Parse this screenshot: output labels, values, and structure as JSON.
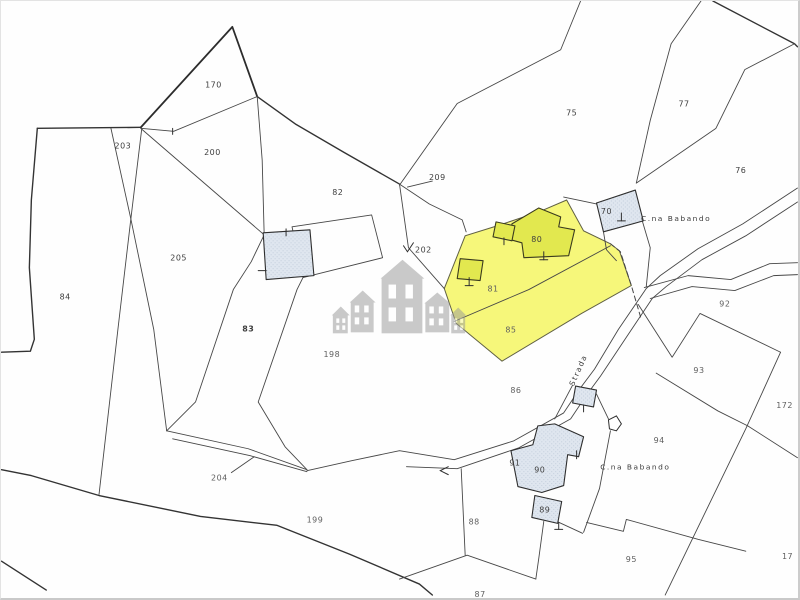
{
  "map": {
    "kind": "cadastral-parcel-map",
    "highlighted_parcels": [
      "81",
      "85"
    ],
    "colors": {
      "highlight_fill": "#f6f768",
      "highlight_building_fill": "#e2e84f",
      "building_fill": "#dfe6ef",
      "line": "#474747",
      "watermark": "#9a9a9a",
      "background": "#fefefe"
    },
    "parcel_labels": [
      {
        "text": "170",
        "x": 213,
        "y": 87
      },
      {
        "text": "203",
        "x": 122,
        "y": 148
      },
      {
        "text": "200",
        "x": 212,
        "y": 155
      },
      {
        "text": "82",
        "x": 338,
        "y": 195
      },
      {
        "text": "209",
        "x": 438,
        "y": 180
      },
      {
        "text": "75",
        "x": 573,
        "y": 115
      },
      {
        "text": "77",
        "x": 686,
        "y": 106
      },
      {
        "text": "76",
        "x": 743,
        "y": 173
      },
      {
        "text": "205",
        "x": 178,
        "y": 261
      },
      {
        "text": "84",
        "x": 64,
        "y": 300
      },
      {
        "text": "83",
        "x": 248,
        "y": 332,
        "size": 13,
        "weight": "600"
      },
      {
        "text": "198",
        "x": 332,
        "y": 358,
        "tone": "light"
      },
      {
        "text": "202",
        "x": 424,
        "y": 253
      },
      {
        "text": "70",
        "x": 608,
        "y": 214
      },
      {
        "text": "80",
        "x": 538,
        "y": 242
      },
      {
        "text": "81",
        "x": 494,
        "y": 292,
        "tone": "light",
        "size": 7
      },
      {
        "text": "85",
        "x": 512,
        "y": 333,
        "tone": "light"
      },
      {
        "text": "86",
        "x": 517,
        "y": 394,
        "tone": "light"
      },
      {
        "text": "92",
        "x": 727,
        "y": 307,
        "tone": "light"
      },
      {
        "text": "93",
        "x": 701,
        "y": 374,
        "tone": "light"
      },
      {
        "text": "172",
        "x": 787,
        "y": 409,
        "tone": "light",
        "anchor": "start"
      },
      {
        "text": "94",
        "x": 661,
        "y": 444,
        "tone": "light"
      },
      {
        "text": "90",
        "x": 541,
        "y": 474
      },
      {
        "text": "91",
        "x": 516,
        "y": 467,
        "size": 7
      },
      {
        "text": "89",
        "x": 546,
        "y": 514
      },
      {
        "text": "88",
        "x": 475,
        "y": 526,
        "tone": "light"
      },
      {
        "text": "95",
        "x": 633,
        "y": 564,
        "tone": "light"
      },
      {
        "text": "87",
        "x": 481,
        "y": 599,
        "tone": "light"
      },
      {
        "text": "199",
        "x": 315,
        "y": 524,
        "tone": "light"
      },
      {
        "text": "204",
        "x": 219,
        "y": 482,
        "tone": "light"
      },
      {
        "text": "17",
        "x": 790,
        "y": 561,
        "tone": "light",
        "anchor": "start"
      }
    ],
    "place_labels": [
      {
        "text": "C.na Babando",
        "x": 678,
        "y": 221
      },
      {
        "text": "C.na Babando",
        "x": 637,
        "y": 471
      },
      {
        "text": "Strada",
        "x": 582,
        "y": 372,
        "rotation": -66
      }
    ]
  }
}
